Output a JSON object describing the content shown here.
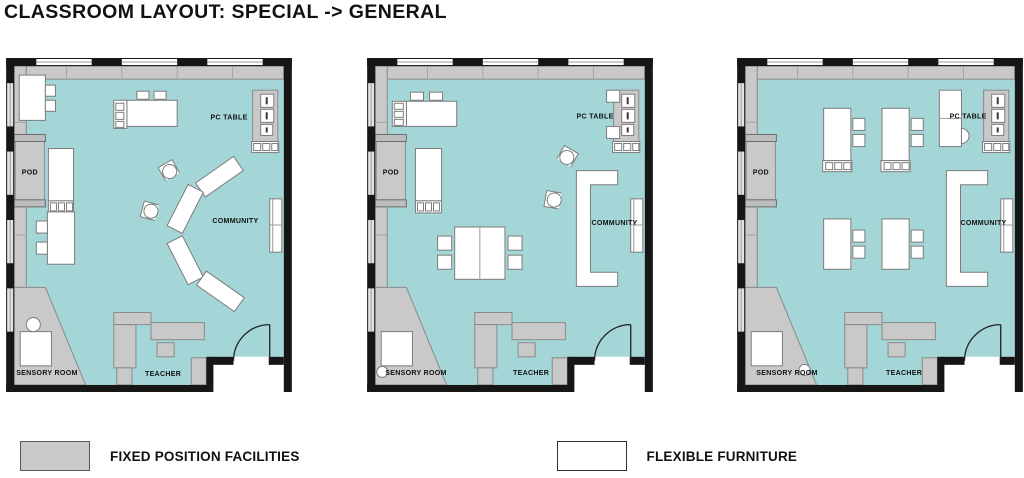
{
  "title": "CLASSROOM LAYOUT: SPECIAL -> GENERAL",
  "colors": {
    "background": "#ffffff",
    "wall": "#161616",
    "floor": "#a4d6d7",
    "fixed": "#c9c9c9",
    "fixed_dark": "#bdbdbd",
    "fixed_border": "#8a8a8a",
    "furniture": "#ffffff",
    "furniture_border": "#7d7d7d",
    "text": "#111111"
  },
  "plans": [
    {
      "id": "plan-1",
      "labels": {
        "pod": "POD",
        "pc_table": "PC TABLE",
        "community": "COMMUNITY",
        "sensory_room": "SENSORY ROOM",
        "teacher": "TEACHER"
      }
    },
    {
      "id": "plan-2",
      "labels": {
        "pod": "POD",
        "pc_table": "PC TABLE",
        "community": "COMMUNITY",
        "sensory_room": "SENSORY ROOM",
        "teacher": "TEACHER"
      }
    },
    {
      "id": "plan-3",
      "labels": {
        "pod": "POD",
        "pc_table": "PC TABLE",
        "community": "COMMUNITY",
        "sensory_room": "SENSORY ROOM",
        "teacher": "TEACHER"
      }
    }
  ],
  "legend": {
    "items": [
      {
        "key": "fixed",
        "label": "FIXED POSITION FACILITIES",
        "swatch_color": "#c9c9c9"
      },
      {
        "key": "flexible",
        "label": "FLEXIBLE FURNITURE",
        "swatch_color": "#ffffff"
      }
    ]
  }
}
